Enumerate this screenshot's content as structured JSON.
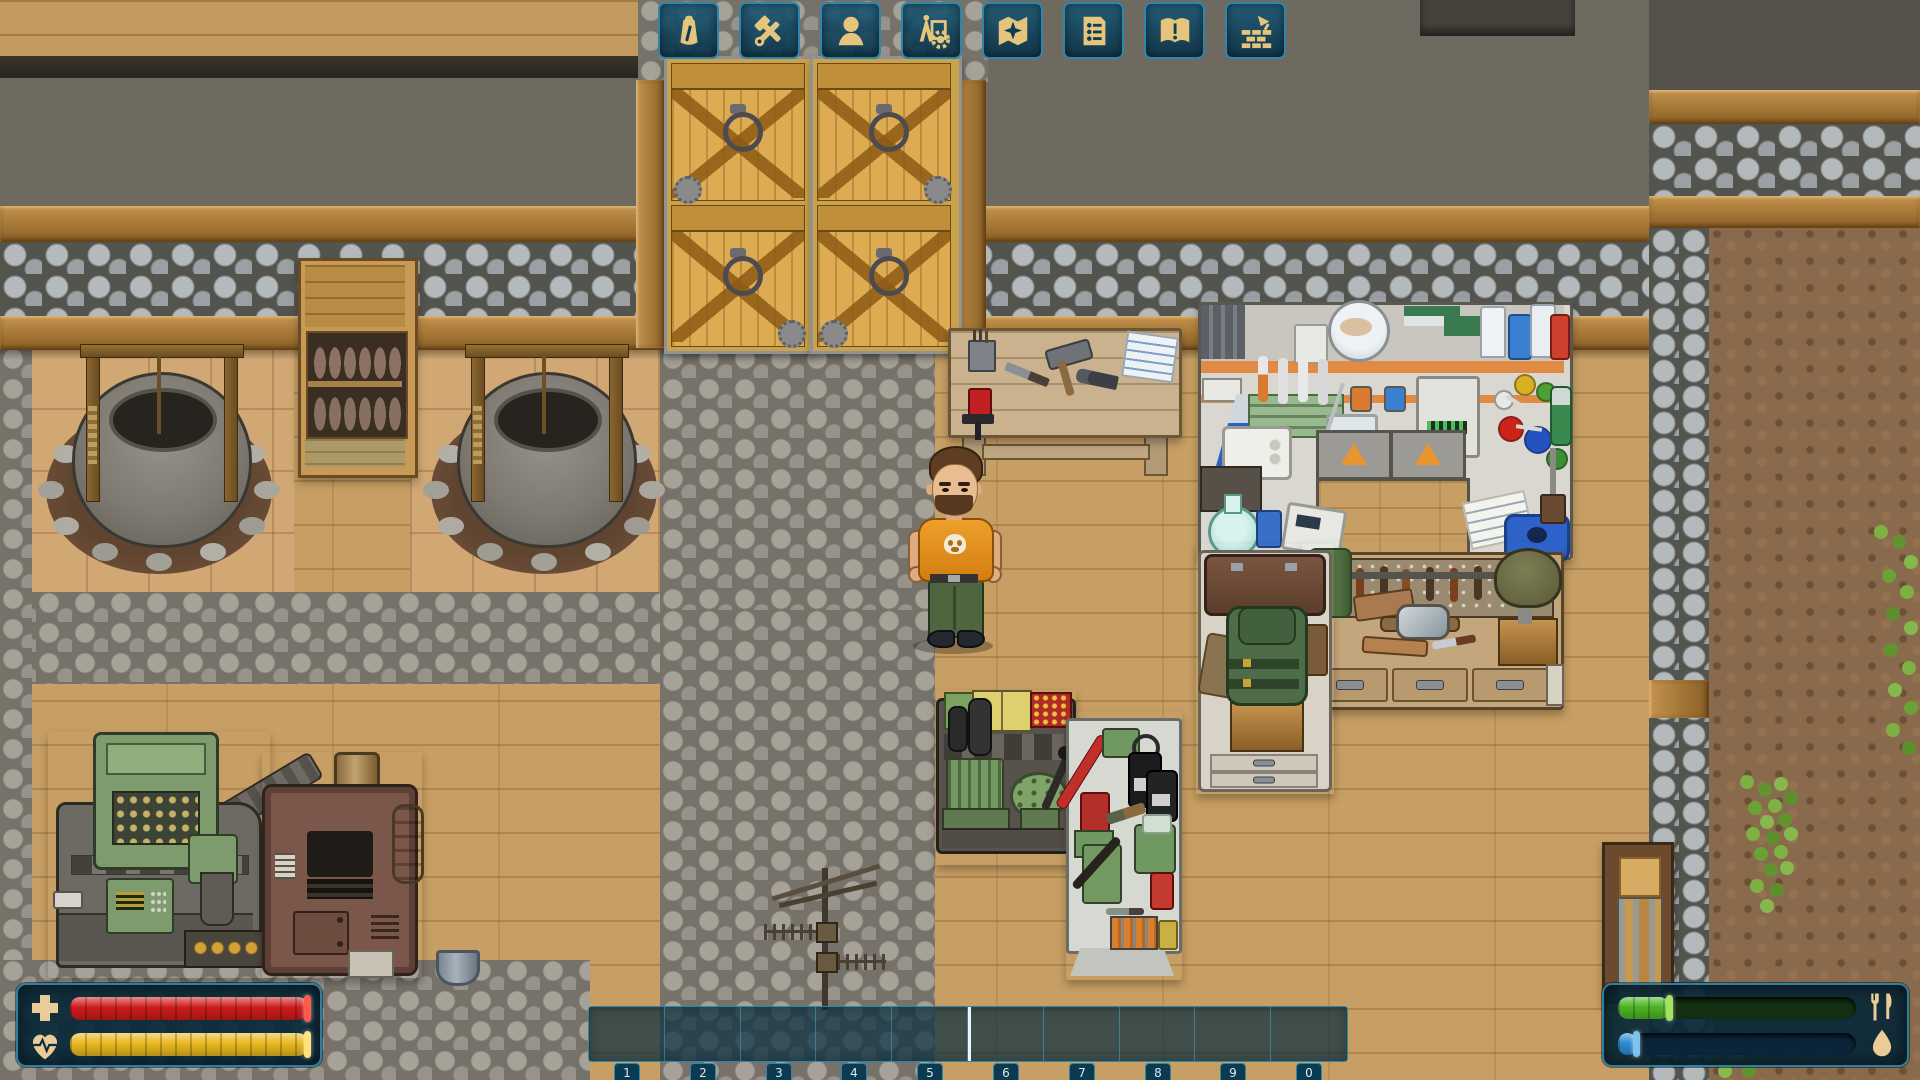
{
  "app": {
    "title": "2D survival colony game — base interior view"
  },
  "colors": {
    "ui_accent": "#2f86ad",
    "ui_panel": "#0a2e41",
    "icon_gold": "#e5c47c",
    "health_red": "#cf1b1b",
    "stamina_gold": "#e8b81e",
    "food_green": "#4db425",
    "water_blue": "#2d8bd2"
  },
  "ui": {
    "toolbar": {
      "buttons": [
        {
          "id": "inventory",
          "icon": "backpack-icon"
        },
        {
          "id": "crafting",
          "icon": "hammer-wrench-icon"
        },
        {
          "id": "character",
          "icon": "person-bust-icon"
        },
        {
          "id": "construction",
          "icon": "compass-gear-icon"
        },
        {
          "id": "map",
          "icon": "map-compass-icon"
        },
        {
          "id": "social",
          "icon": "roster-list-icon"
        },
        {
          "id": "quests",
          "icon": "open-book-icon"
        },
        {
          "id": "building",
          "icon": "brick-trowel-icon"
        }
      ]
    },
    "vitals": {
      "health": {
        "percent": 100,
        "bar_color": "#cf1b1b",
        "icon": "medical-cross-icon"
      },
      "stamina": {
        "percent": 100,
        "bar_color": "#e8b81e",
        "icon": "heart-pulse-icon"
      }
    },
    "needs": {
      "food": {
        "percent": 22,
        "bar_color": "#4db425",
        "cap_color": "#a2e35c",
        "icon": "fork-knife-icon"
      },
      "water": {
        "percent": 8,
        "bar_color": "#2d8bd2",
        "cap_color": "#7ac4f0",
        "icon": "water-drop-icon"
      }
    },
    "hotbar": {
      "slots": [
        "1",
        "2",
        "3",
        "4",
        "5",
        "6",
        "7",
        "8",
        "9",
        "0"
      ],
      "selected_boundary_before_slot": 6
    }
  },
  "scene": {
    "entities": [
      "wooden-gate-left",
      "wooden-gate-right",
      "stone-perimeter-wall",
      "drying-cabinet",
      "water-well-left",
      "water-well-right",
      "rustic-workbench",
      "chemistry-lab-table",
      "armor-workbench",
      "backpack-stand-table",
      "ammo-workbench",
      "reloading-bench",
      "coin-mint-machine",
      "furnace",
      "metal-bucket",
      "radio-antenna",
      "wall-door",
      "player-character",
      "yard-bushes"
    ]
  }
}
